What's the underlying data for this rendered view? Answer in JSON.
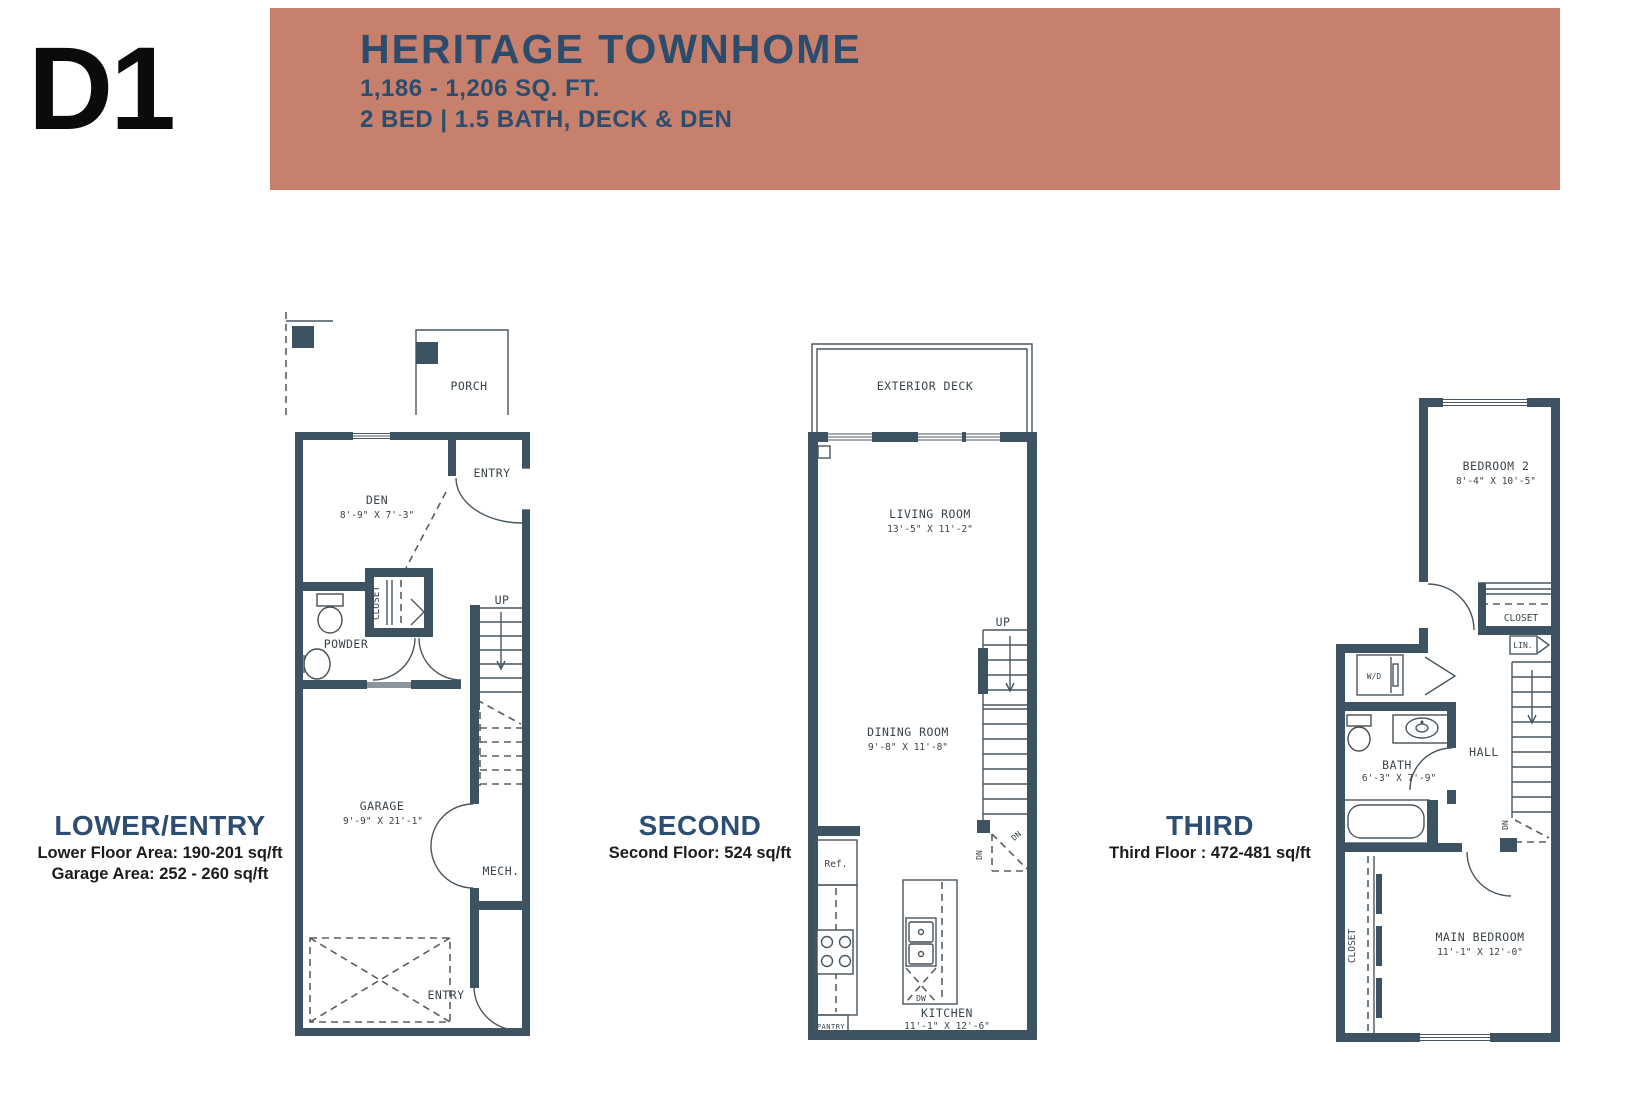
{
  "header": {
    "plan_code": "D1",
    "title": "HERITAGE TOWNHOME",
    "size_range": "1,186 - 1,206 SQ. FT.",
    "configuration": "2 BED | 1.5 BATH, DECK & DEN"
  },
  "colors": {
    "banner": "#C6806B",
    "heading_text": "#2C4C6E",
    "floor_name_text": "#2E4E71",
    "wall": "#3E5362"
  },
  "floors": [
    {
      "id": "lower",
      "name": "LOWER/ENTRY",
      "area_lines": [
        "Lower Floor Area: 190-201 sq/ft",
        "Garage Area: 252 - 260 sq/ft"
      ],
      "labels": {
        "porch": "PORCH",
        "entry_upper": "ENTRY",
        "den": "DEN",
        "den_dim": "8'-9\" X 7'-3\"",
        "closet": "CLOSET",
        "powder": "POWDER",
        "up": "UP",
        "garage": "GARAGE",
        "garage_dim": "9'-9\" X 21'-1\"",
        "mech": "MECH.",
        "entry_lower": "ENTRY"
      }
    },
    {
      "id": "second",
      "name": "SECOND",
      "area_lines": [
        "Second Floor: 524 sq/ft"
      ],
      "labels": {
        "exterior_deck": "EXTERIOR DECK",
        "living": "LIVING ROOM",
        "living_dim": "13'-5\" X 11'-2\"",
        "up": "UP",
        "dining": "DINING ROOM",
        "dining_dim": "9'-8\" X 11'-8\"",
        "dn_1": "DN",
        "dn_2": "DN",
        "fridge": "Ref.",
        "pantry": "PANTRY",
        "dishwasher": "DW",
        "kitchen": "KITCHEN",
        "kitchen_dim": "11'-1\" X 12'-6\""
      }
    },
    {
      "id": "third",
      "name": "THIRD",
      "area_lines": [
        "Third Floor : 472-481 sq/ft"
      ],
      "labels": {
        "bedroom2": "BEDROOM 2",
        "bedroom2_dim": "8'-4\" X 10'-5\"",
        "closet_upper": "CLOSET",
        "linen": "LIN.",
        "washer_dryer": "W/D",
        "bath": "BATH",
        "bath_dim": "6'-3\" X 7'-9\"",
        "hall": "HALL",
        "dn": "DN",
        "closet_lower": "CLOSET",
        "main_bedroom": "MAIN BEDROOM",
        "main_bedroom_dim": "11'-1\" X 12'-0\""
      }
    }
  ]
}
